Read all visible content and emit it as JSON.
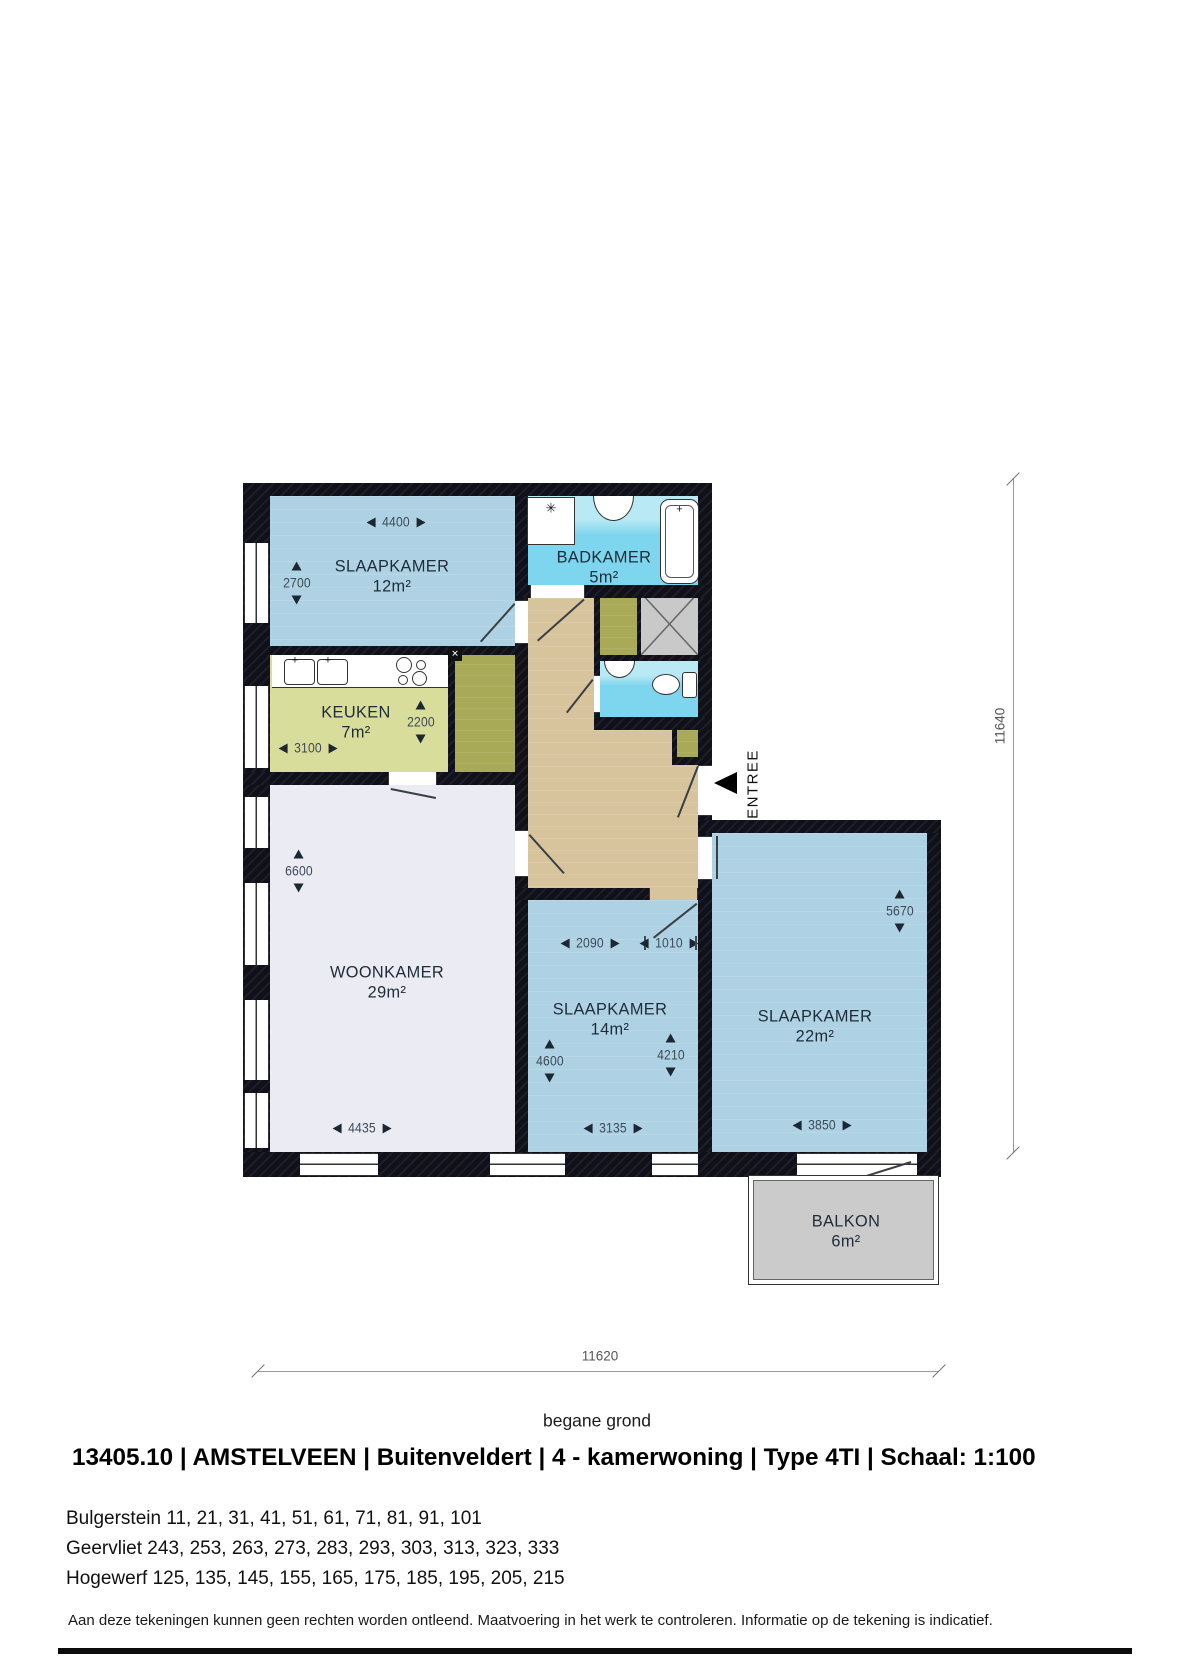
{
  "plan": {
    "floor_label": "begane grond",
    "entree_label": "ENTREE",
    "rooms": {
      "bedroom1": {
        "name": "SLAAPKAMER",
        "area": "12m²"
      },
      "bathroom": {
        "name": "BADKAMER",
        "area": "5m²"
      },
      "kitchen": {
        "name": "KEUKEN",
        "area": "7m²"
      },
      "livingroom": {
        "name": "WOONKAMER",
        "area": "29m²"
      },
      "bedroom2": {
        "name": "SLAAPKAMER",
        "area": "14m²"
      },
      "bedroom3": {
        "name": "SLAAPKAMER",
        "area": "22m²"
      },
      "balcony": {
        "name": "BALKON",
        "area": "6m²"
      }
    },
    "dimensions": {
      "bedroom1_width": "4400",
      "bedroom1_depth": "2700",
      "kitchen_width": "3100",
      "kitchen_depth": "2200",
      "livingroom_depth": "6600",
      "livingroom_width": "4435",
      "bedroom2_top_width": "2090",
      "hall_passage": "1010",
      "bedroom2_depth_left": "4600",
      "bedroom2_depth_right": "4210",
      "bedroom2_width": "3135",
      "bedroom3_depth": "5670",
      "bedroom3_width": "3850",
      "total_depth": "11640",
      "total_width": "11620"
    }
  },
  "icons": {
    "washer_tap": "✳",
    "faucet": "+",
    "boiler_cross": "✕"
  },
  "title_block": {
    "title": "13405.10 | AMSTELVEEN | Buitenveldert |  4 - kamerwoning  |  Type 4TI | Schaal:  1:100",
    "addresses": [
      "Bulgerstein 11, 21, 31, 41, 51, 61, 71, 81, 91, 101",
      "Geervliet 243, 253, 263, 273, 283, 293, 303, 313, 323, 333",
      "Hogewerf 125, 135, 145, 155, 165, 175, 185, 195, 205, 215"
    ],
    "disclaimer": "Aan deze tekeningen kunnen geen rechten worden ontleend. Maatvoering in het werk te controleren. Informatie op de tekening is indicatief."
  },
  "colors": {
    "wall": "#10101a",
    "bedroom": "#aed2e3",
    "bath": "#7ed5ee",
    "bathlight": "#b9e9f4",
    "kitchen": "#d9dd9c",
    "olive": "#a8aa57",
    "hall": "#d8c49c",
    "living": "#eaebf3",
    "balcony": "#cbcbcb",
    "shaft": "#c9c9c9",
    "label": "#1e2b38",
    "dim": "#3d4a57",
    "tri": "#1c2733",
    "dimline": "#999999"
  }
}
